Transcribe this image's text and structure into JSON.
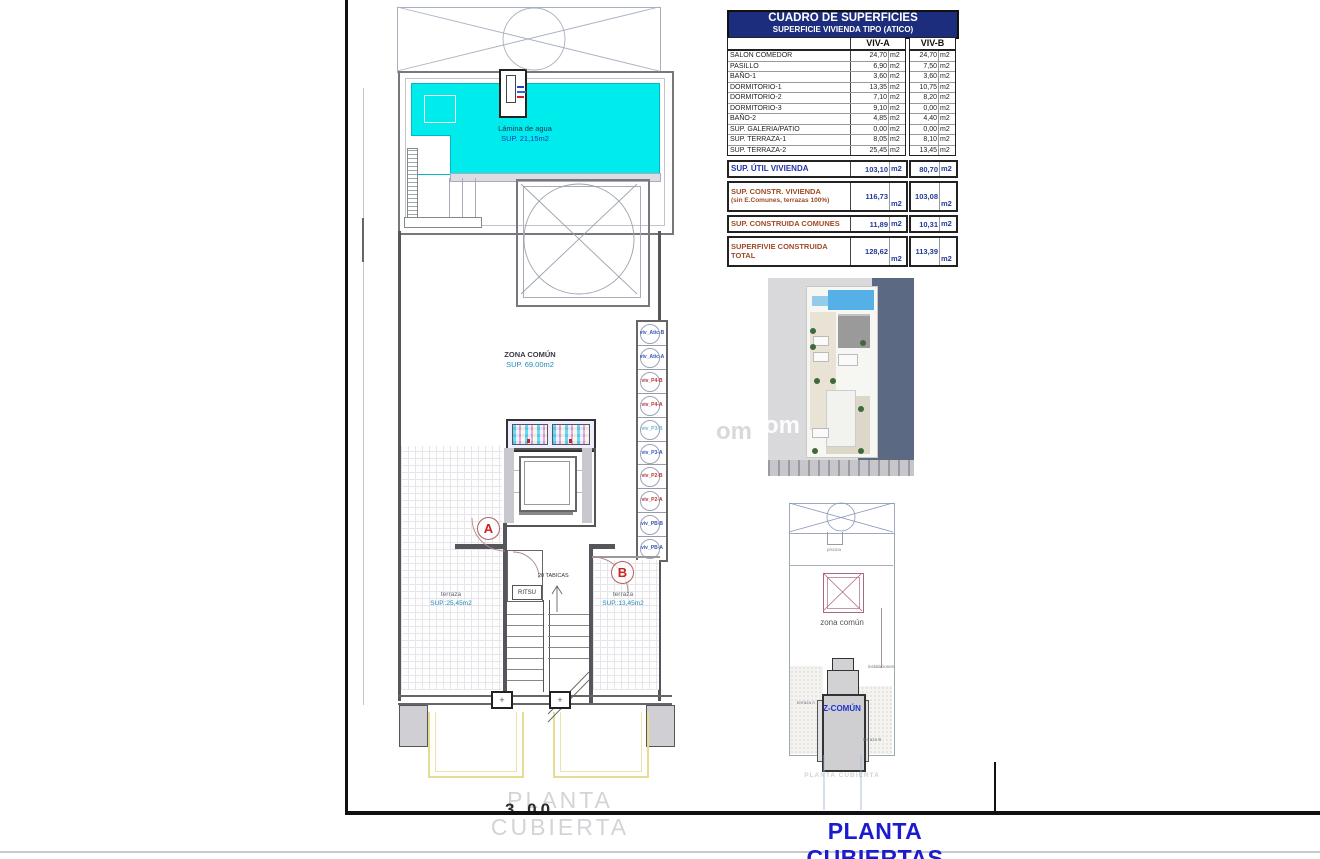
{
  "sheet": {
    "title": "PLANTA CUBIERTAS",
    "caption": "PLANTA CUBIERTA",
    "caption_cut": "3,00"
  },
  "plan": {
    "pool": {
      "line1": "Lámina de agua",
      "line2": "SUP. 21,15m2"
    },
    "zona": {
      "line1": "ZONA COMÚN",
      "line2": "SUP. 69.00m2"
    },
    "section_a": "A",
    "section_b": "B",
    "terraza_left": {
      "name": "terraza",
      "sup": "SUP.:25,45m2"
    },
    "terraza_right": {
      "name": "terraza",
      "sup": "SUP.:13,45m2"
    },
    "ritsu": "RITSU",
    "tabicas": "20 TABICAS",
    "plus": "+",
    "shaft": [
      {
        "label": "viv_Atic-B",
        "color": "#3a55b4"
      },
      {
        "label": "viv_Atic-A",
        "color": "#3a55b4"
      },
      {
        "label": "viv_P4-B",
        "color": "#bb3333"
      },
      {
        "label": "viv_P4-A",
        "color": "#bb3333"
      },
      {
        "label": "viv_P3-B",
        "color": "#6fb6d8"
      },
      {
        "label": "viv_P3-A",
        "color": "#3a55b4"
      },
      {
        "label": "viv_P2-B",
        "color": "#bb3333"
      },
      {
        "label": "viv_P2-A",
        "color": "#bb3333"
      },
      {
        "label": "viv_PB-B",
        "color": "#3a55b4"
      },
      {
        "label": "viv_PB-A",
        "color": "#3a55b4"
      }
    ]
  },
  "table": {
    "title": "CUADRO DE SUPERFICIES",
    "subtitle": "SUPERFICIE VIVIENDA TIPO  (ATICO)",
    "col_a": "VIV-A",
    "col_b": "VIV-B",
    "unit": "m2",
    "rows": [
      {
        "label": "SALON COMEDOR",
        "a": "24,70",
        "b": "24,70"
      },
      {
        "label": "PASILLO",
        "a": "6,90",
        "b": "7,50"
      },
      {
        "label": "BAÑO-1",
        "a": "3,60",
        "b": "3,60"
      },
      {
        "label": "DORMITORIO-1",
        "a": "13,35",
        "b": "10,75"
      },
      {
        "label": "DORMITORIO-2",
        "a": "7,10",
        "b": "8,20"
      },
      {
        "label": "DORMITORIO-3",
        "a": "9,10",
        "b": "0,00"
      },
      {
        "label": "BAÑO-2",
        "a": "4,85",
        "b": "4,40"
      },
      {
        "label": "SUP. GALERIA/PATIO",
        "a": "0,00",
        "b": "0,00"
      },
      {
        "label": "SUP. TERRAZA-1",
        "a": "8,05",
        "b": "8,10"
      },
      {
        "label": "SUP. TERRAZA-2",
        "a": "25,45",
        "b": "13,45"
      }
    ],
    "summary": {
      "util": {
        "label": "SUP. ÚTIL VIVIENDA",
        "a": "103,10",
        "b": "80,70"
      },
      "constr": {
        "label": "SUP. CONSTR. VIVIENDA",
        "label2": "(sin E.Comunes, terrazas 100%)",
        "a": "116,73",
        "b": "103,08"
      },
      "comunes": {
        "label": "SUP. CONSTRUIDA COMUNES",
        "a": "11,89",
        "b": "10,31"
      },
      "total": {
        "label": "SUPERFIVIE CONSTRUIDA",
        "label2": "TOTAL",
        "a": "128,62",
        "b": "113,39"
      }
    }
  },
  "schematic": {
    "piscina": "piscina",
    "zona": "zona común",
    "zcomun": "Z-COMÚN",
    "instalaciones": "instalaciones",
    "terraza_a": "terraza A",
    "terraza_b": "terraza B",
    "caption": "PLANTA CUBIERTA"
  },
  "watermark": "om"
}
